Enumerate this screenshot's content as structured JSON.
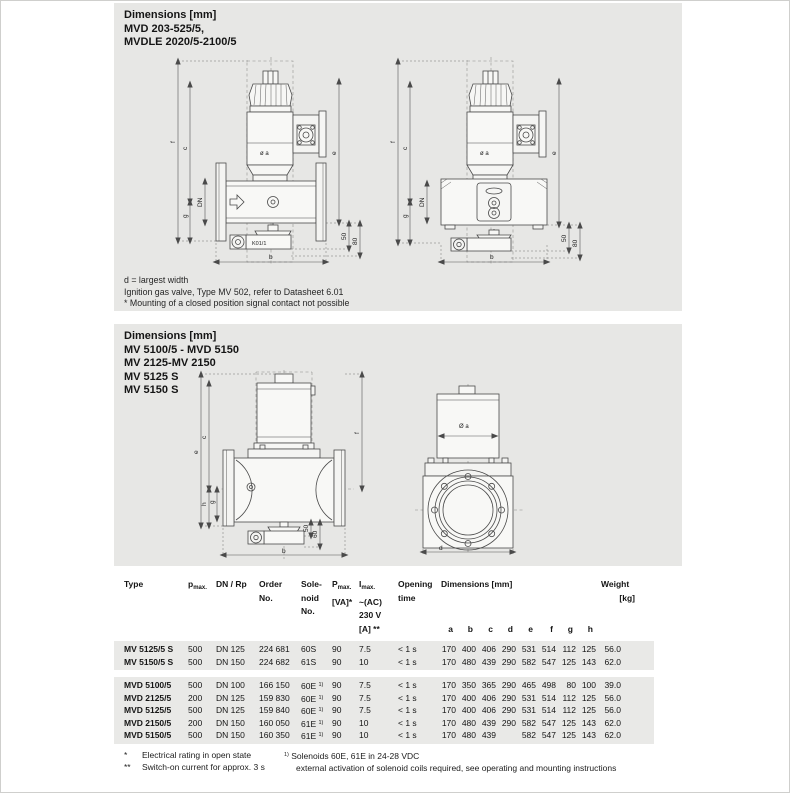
{
  "panel1": {
    "title_lines": [
      "Dimensions [mm]",
      "MVD 203-525/5,",
      "MVDLE 2020/5-2100/5"
    ],
    "footnotes": [
      "d = largest width",
      "Ignition gas valve, Type MV 502, refer to Datasheet 6.01",
      "* Mounting of a closed position signal contact not possible"
    ],
    "labels": {
      "f": "f",
      "c": "c",
      "dn": "DN",
      "g": "g",
      "e": "e",
      "n50": "50",
      "n80": "80",
      "b": "b",
      "dia": "ø a",
      "k": "K01/1"
    }
  },
  "panel2": {
    "title_lines": [
      "Dimensions [mm]",
      "MV 5100/5 - MVD 5150",
      "MV 2125-MV 2150",
      "MV 5125 S",
      "MV 5150 S"
    ],
    "labels": {
      "e": "e",
      "c": "c",
      "g": "g",
      "h": "h",
      "f": "f",
      "n50": "50",
      "n60": "60",
      "b": "b",
      "dia": "Ø a",
      "d": "d"
    }
  },
  "table": {
    "headers": {
      "type": "Type",
      "pmax_main": "p",
      "pmax_sub": "max.",
      "dn": "DN / Rp",
      "order1": "Order",
      "order2": "No.",
      "sol1": "Sole-",
      "sol2": "noid",
      "sol3": "No.",
      "p_main": "P",
      "p_sub": "max.",
      "p_unit": "[VA]*",
      "i_main": "I",
      "i_sub": "max.",
      "i2": "~(AC)",
      "i3": "230 V",
      "i4": "[A] **",
      "open1": "Opening",
      "open2": "time",
      "dims": "Dimensions [mm]",
      "dim_letters": [
        "a",
        "b",
        "c",
        "d",
        "e",
        "f",
        "g",
        "h"
      ],
      "weight1": "Weight",
      "weight2": "[kg]"
    },
    "groups": [
      {
        "rows": [
          {
            "type": "MV 5125/5 S",
            "pmax": "500",
            "dn": "DN 125",
            "order": "224 681",
            "sol": "60S",
            "sol_sup": "",
            "p": "90",
            "i": "7.5",
            "open": "< 1 s",
            "dims": [
              "170",
              "400",
              "406",
              "290",
              "531",
              "514",
              "112",
              "125"
            ],
            "weight": "56.0"
          },
          {
            "type": "MV 5150/5 S",
            "pmax": "500",
            "dn": "DN 150",
            "order": "224 682",
            "sol": "61S",
            "sol_sup": "",
            "p": "90",
            "i": "10",
            "open": "< 1 s",
            "dims": [
              "170",
              "480",
              "439",
              "290",
              "582",
              "547",
              "125",
              "143"
            ],
            "weight": "62.0"
          }
        ]
      },
      {
        "rows": [
          {
            "type": "MVD 5100/5",
            "pmax": "500",
            "dn": "DN 100",
            "order": "166 150",
            "sol": "60E",
            "sol_sup": "1)",
            "p": "90",
            "i": "7.5",
            "open": "< 1 s",
            "dims": [
              "170",
              "350",
              "365",
              "290",
              "465",
              "498",
              "80",
              "100"
            ],
            "weight": "39.0"
          },
          {
            "type": "MVD 2125/5",
            "pmax": "200",
            "dn": "DN 125",
            "order": "159 830",
            "sol": "60E",
            "sol_sup": "1)",
            "p": "90",
            "i": "7.5",
            "open": "< 1 s",
            "dims": [
              "170",
              "400",
              "406",
              "290",
              "531",
              "514",
              "112",
              "125"
            ],
            "weight": "56.0"
          },
          {
            "type": "MVD 5125/5",
            "pmax": "500",
            "dn": "DN 125",
            "order": "159 840",
            "sol": "60E",
            "sol_sup": "1)",
            "p": "90",
            "i": "7.5",
            "open": "< 1 s",
            "dims": [
              "170",
              "400",
              "406",
              "290",
              "531",
              "514",
              "112",
              "125"
            ],
            "weight": "56.0"
          },
          {
            "type": "MVD 2150/5",
            "pmax": "200",
            "dn": "DN 150",
            "order": "160 050",
            "sol": "61E",
            "sol_sup": "1)",
            "p": "90",
            "i": "10",
            "open": "< 1 s",
            "dims": [
              "170",
              "480",
              "439",
              "290",
              "582",
              "547",
              "125",
              "143"
            ],
            "weight": "62.0"
          },
          {
            "type": "MVD 5150/5",
            "pmax": "500",
            "dn": "DN 150",
            "order": "160 350",
            "sol": "61E",
            "sol_sup": "1)",
            "p": "90",
            "i": "10",
            "open": "< 1 s",
            "dims": [
              "170",
              "480",
              "439",
              "",
              "582",
              "547",
              "125",
              "143"
            ],
            "weight": "62.0"
          }
        ]
      }
    ]
  },
  "footnotes": {
    "left": [
      {
        "marker": "*",
        "text": "Electrical rating in open state"
      },
      {
        "marker": "**",
        "text": "Switch-on current for approx. 3 s"
      }
    ],
    "right_sup": "1)",
    "right_line1": "Solenoids 60E, 61E in 24-28 VDC",
    "right_line2": "external activation of solenoid coils required, see operating and mounting instructions"
  }
}
